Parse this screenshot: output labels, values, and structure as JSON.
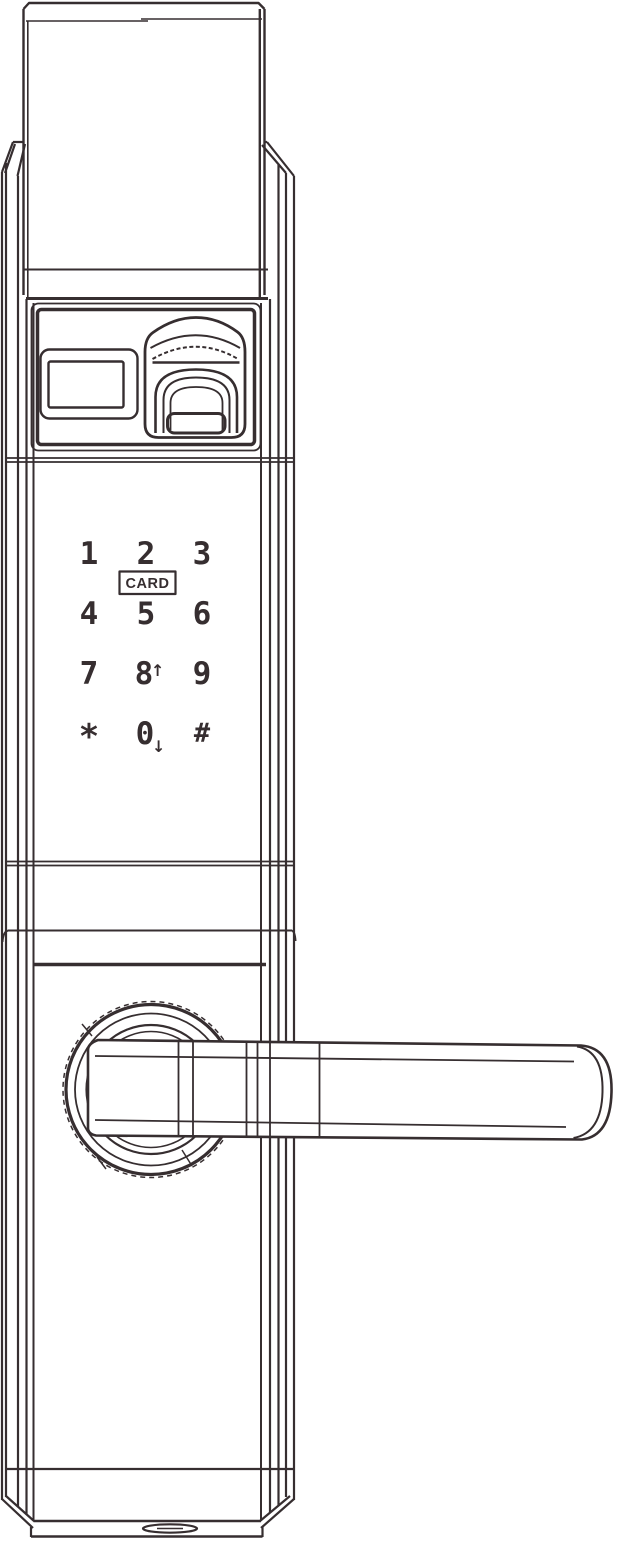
{
  "drawing": {
    "subject": "smart-door-lock-front-view",
    "colors": {
      "line": "#362e30",
      "background": "#ffffff"
    }
  },
  "panel": {
    "display_icon": "status-display-window",
    "fingerprint_icon": "fingerprint-scanner"
  },
  "keypad": {
    "card_label": "CARD",
    "keys": [
      {
        "label": "1"
      },
      {
        "label": "2"
      },
      {
        "label": "3"
      },
      {
        "label": "4"
      },
      {
        "label": "5"
      },
      {
        "label": "6"
      },
      {
        "label": "7"
      },
      {
        "label": "8",
        "arrow": "↑"
      },
      {
        "label": "9"
      },
      {
        "label": "*"
      },
      {
        "label": "0",
        "arrow": "↓"
      },
      {
        "label": "#"
      }
    ]
  },
  "handle": {
    "lever_icon": "door-handle-lever",
    "rose_icon": "handle-rose"
  },
  "bottom": {
    "port_icon": "emergency-port-oval"
  }
}
